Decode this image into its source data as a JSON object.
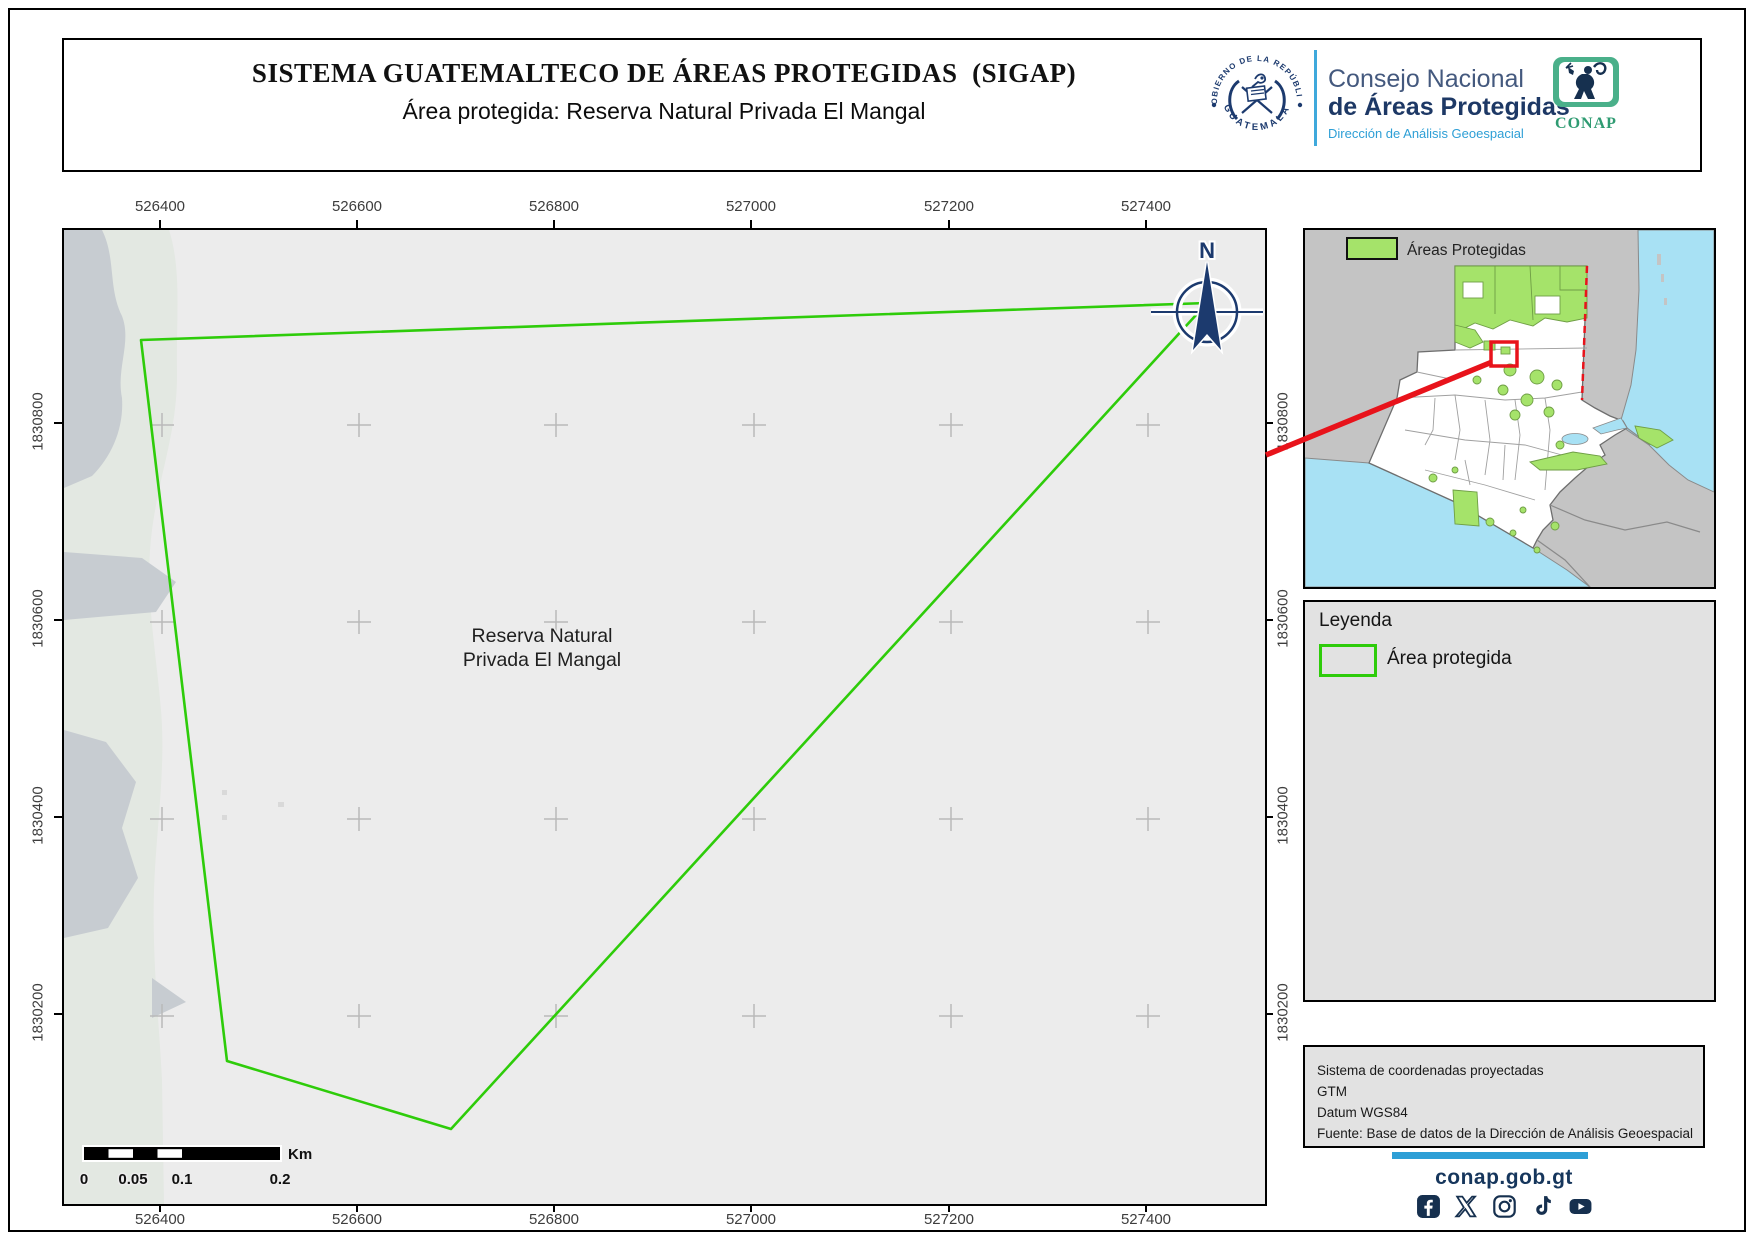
{
  "title_box": {
    "title": "SISTEMA GUATEMALTECO DE ÁREAS PROTEGIDAS  (SIGAP)",
    "subtitle": "Área protegida: Reserva Natural Privada El Mangal"
  },
  "logos": {
    "seal_top": "GOBIERNO DE LA REPÚBLICA",
    "seal_bottom": "GUATEMALA",
    "council_line1": "Consejo Nacional",
    "council_line2": "de Áreas Protegidas",
    "council_line3": "Dirección de Análisis Geoespacial",
    "conap": "CONAP"
  },
  "map": {
    "x_ticks": [
      "526400",
      "526600",
      "526800",
      "527000",
      "527200",
      "527400"
    ],
    "y_ticks": [
      "1830800",
      "1830600",
      "1830400",
      "1830200"
    ],
    "area_label_line1": "Reserva Natural",
    "area_label_line2": "Privada El Mangal",
    "north_label": "N"
  },
  "scalebar": {
    "labels": [
      "0",
      "0.05",
      "0.1",
      "0.2"
    ],
    "unit": "Km"
  },
  "inset": {
    "legend_label": "Áreas Protegidas"
  },
  "legend_panel": {
    "title": "Leyenda",
    "item_label": "Área protegida"
  },
  "info_box": {
    "lines": [
      "Sistema de coordenadas proyectadas",
      "GTM",
      "Datum WGS84",
      "Fuente: Base de datos de la Dirección de Análisis Geoespacial"
    ]
  },
  "footer": {
    "website": "conap.gob.gt",
    "social": [
      "facebook",
      "x",
      "instagram",
      "tiktok",
      "youtube"
    ]
  },
  "colors": {
    "protected_green": "#2ecc0a",
    "inset_green": "#a5e36a",
    "red": "#e8131b",
    "navy": "#16365c",
    "accent_blue": "#2e9fd6",
    "sea": "#a8e1f4"
  }
}
